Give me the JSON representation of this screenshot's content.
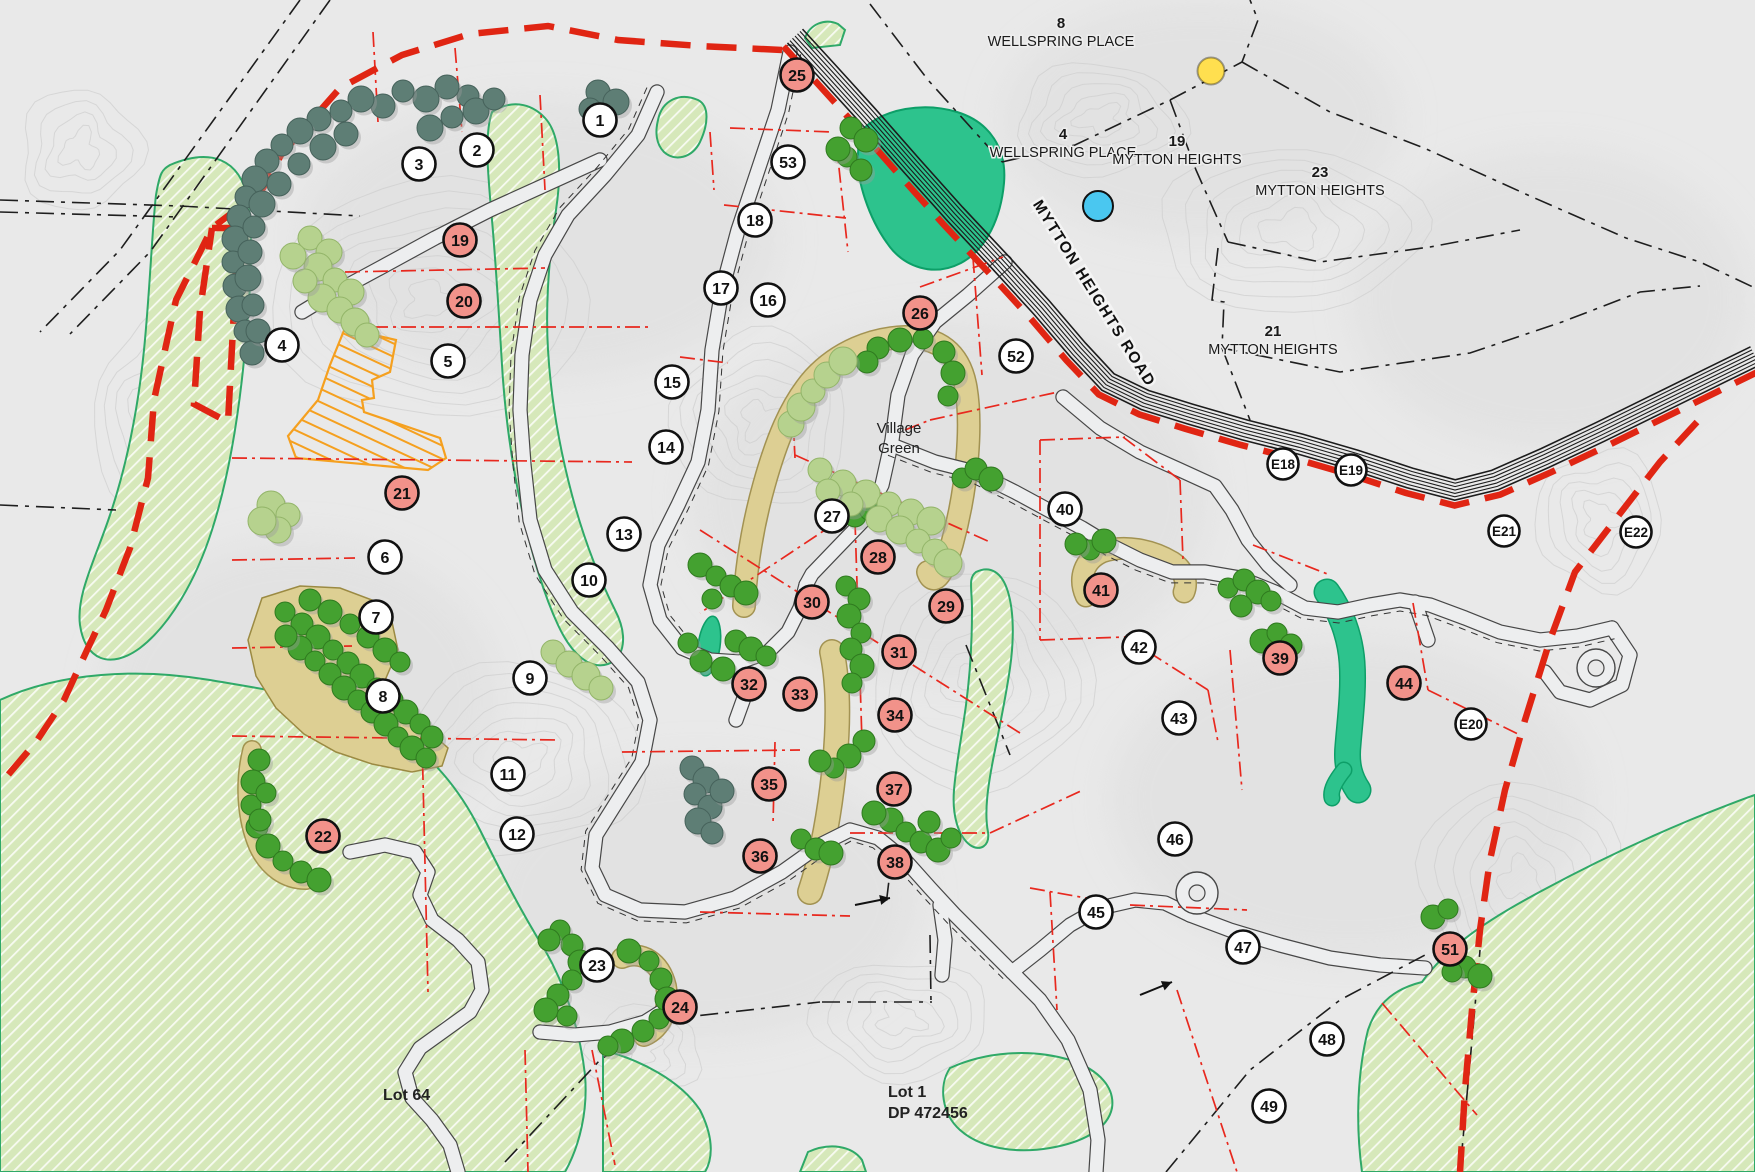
{
  "map_type": "subdivision-site-plan",
  "colors": {
    "bg": "#e9e9e9",
    "contour": "#cfcfcf",
    "boundary_red": "#e02513",
    "lot_line_red": "#e8281e",
    "green_area_fill": "#d6e8ba",
    "green_area_stroke": "#2fa968",
    "pond_fill": "#2dc38d",
    "pond_stroke": "#0d9f68",
    "tan_fill": "#ddcf93",
    "tan_stroke": "#9b8a42",
    "orange_building": "#f5a01f",
    "tree_dark": "#5e7e75",
    "tree_dark_stroke": "#46625b",
    "tree_green": "#44a130",
    "tree_green_stroke": "#2f7a1f",
    "tree_light": "#b6d28e",
    "tree_light_stroke": "#93b569",
    "road_fill": "#edeeef",
    "road_casing": "#474747",
    "cadastral_black": "#1e1e1e",
    "marker_white": "#ffffff",
    "marker_salmon": "#f2928a",
    "marker_stroke": "#111111",
    "dot_yellow": "#ffdf4f",
    "dot_blue": "#4ac7f0"
  },
  "labels": {
    "streets": [
      {
        "id": "wellspring-place-8",
        "number": "8",
        "name": "WELLSPRING PLACE",
        "x": 1061,
        "y": 28
      },
      {
        "id": "wellspring-place-4",
        "number": "4",
        "name": "WELLSPRING PLACE",
        "x": 1063,
        "y": 139
      },
      {
        "id": "mytton-heights-19",
        "number": "19",
        "name": "MYTTON HEIGHTS",
        "x": 1177,
        "y": 146
      },
      {
        "id": "mytton-heights-23",
        "number": "23",
        "name": "MYTTON HEIGHTS",
        "x": 1320,
        "y": 177
      },
      {
        "id": "mytton-heights-21",
        "number": "21",
        "name": "MYTTON HEIGHTS",
        "x": 1273,
        "y": 336
      }
    ],
    "road": {
      "text": "MYTTON HEIGHTS ROAD",
      "x": 1090,
      "y": 296,
      "rotation": 58
    },
    "areas": [
      {
        "id": "village-green",
        "lines": [
          "Village",
          "Green"
        ],
        "x": 899,
        "y": 433,
        "anchor": "middle",
        "size": 15,
        "weight": 400
      },
      {
        "id": "lot-64",
        "lines": [
          "Lot 64"
        ],
        "x": 383,
        "y": 1100,
        "anchor": "start",
        "size": 16,
        "weight": 700
      },
      {
        "id": "lot-1",
        "lines": [
          "Lot 1",
          "DP 472456"
        ],
        "x": 888,
        "y": 1097,
        "anchor": "start",
        "size": 16,
        "weight": 700
      }
    ]
  },
  "markers": {
    "white": [
      {
        "label": "1",
        "x": 600,
        "y": 120
      },
      {
        "label": "2",
        "x": 477,
        "y": 150
      },
      {
        "label": "3",
        "x": 419,
        "y": 164
      },
      {
        "label": "4",
        "x": 282,
        "y": 345
      },
      {
        "label": "5",
        "x": 448,
        "y": 361
      },
      {
        "label": "6",
        "x": 385,
        "y": 557
      },
      {
        "label": "7",
        "x": 376,
        "y": 617
      },
      {
        "label": "8",
        "x": 383,
        "y": 696
      },
      {
        "label": "9",
        "x": 530,
        "y": 678
      },
      {
        "label": "10",
        "x": 589,
        "y": 580
      },
      {
        "label": "11",
        "x": 508,
        "y": 774
      },
      {
        "label": "12",
        "x": 517,
        "y": 834
      },
      {
        "label": "13",
        "x": 624,
        "y": 534
      },
      {
        "label": "14",
        "x": 666,
        "y": 447
      },
      {
        "label": "15",
        "x": 672,
        "y": 382
      },
      {
        "label": "16",
        "x": 768,
        "y": 300
      },
      {
        "label": "17",
        "x": 721,
        "y": 288
      },
      {
        "label": "18",
        "x": 755,
        "y": 220
      },
      {
        "label": "23",
        "x": 597,
        "y": 965
      },
      {
        "label": "27",
        "x": 832,
        "y": 516
      },
      {
        "label": "40",
        "x": 1065,
        "y": 509
      },
      {
        "label": "42",
        "x": 1139,
        "y": 647
      },
      {
        "label": "43",
        "x": 1179,
        "y": 718
      },
      {
        "label": "45",
        "x": 1096,
        "y": 912
      },
      {
        "label": "46",
        "x": 1175,
        "y": 839
      },
      {
        "label": "47",
        "x": 1243,
        "y": 947
      },
      {
        "label": "48",
        "x": 1327,
        "y": 1039
      },
      {
        "label": "49",
        "x": 1269,
        "y": 1106
      },
      {
        "label": "52",
        "x": 1016,
        "y": 356
      },
      {
        "label": "53",
        "x": 788,
        "y": 162
      }
    ],
    "salmon": [
      {
        "label": "19",
        "x": 460,
        "y": 240
      },
      {
        "label": "20",
        "x": 464,
        "y": 301
      },
      {
        "label": "21",
        "x": 402,
        "y": 493
      },
      {
        "label": "22",
        "x": 323,
        "y": 836
      },
      {
        "label": "24",
        "x": 680,
        "y": 1007
      },
      {
        "label": "25",
        "x": 797,
        "y": 75
      },
      {
        "label": "26",
        "x": 920,
        "y": 313
      },
      {
        "label": "28",
        "x": 878,
        "y": 557
      },
      {
        "label": "29",
        "x": 946,
        "y": 606
      },
      {
        "label": "30",
        "x": 812,
        "y": 602
      },
      {
        "label": "31",
        "x": 899,
        "y": 652
      },
      {
        "label": "32",
        "x": 749,
        "y": 684
      },
      {
        "label": "33",
        "x": 800,
        "y": 694
      },
      {
        "label": "34",
        "x": 895,
        "y": 715
      },
      {
        "label": "35",
        "x": 769,
        "y": 784
      },
      {
        "label": "36",
        "x": 760,
        "y": 856
      },
      {
        "label": "37",
        "x": 894,
        "y": 789
      },
      {
        "label": "38",
        "x": 895,
        "y": 862
      },
      {
        "label": "39",
        "x": 1280,
        "y": 658
      },
      {
        "label": "41",
        "x": 1101,
        "y": 590
      },
      {
        "label": "44",
        "x": 1404,
        "y": 683
      },
      {
        "label": "51",
        "x": 1450,
        "y": 949
      }
    ],
    "estate": [
      {
        "label": "E18",
        "x": 1283,
        "y": 464
      },
      {
        "label": "E19",
        "x": 1351,
        "y": 470
      },
      {
        "label": "E20",
        "x": 1471,
        "y": 724
      },
      {
        "label": "E21",
        "x": 1504,
        "y": 531
      },
      {
        "label": "E22",
        "x": 1636,
        "y": 532
      }
    ]
  },
  "dots": [
    {
      "id": "yellow-dot",
      "x": 1211,
      "y": 71,
      "r": 13.5,
      "colorKey": "dot_yellow",
      "stroke": "rgba(0,0,0,0.35)"
    },
    {
      "id": "blue-dot",
      "x": 1098,
      "y": 206,
      "r": 15,
      "colorKey": "dot_blue",
      "stroke": "#111111"
    }
  ]
}
